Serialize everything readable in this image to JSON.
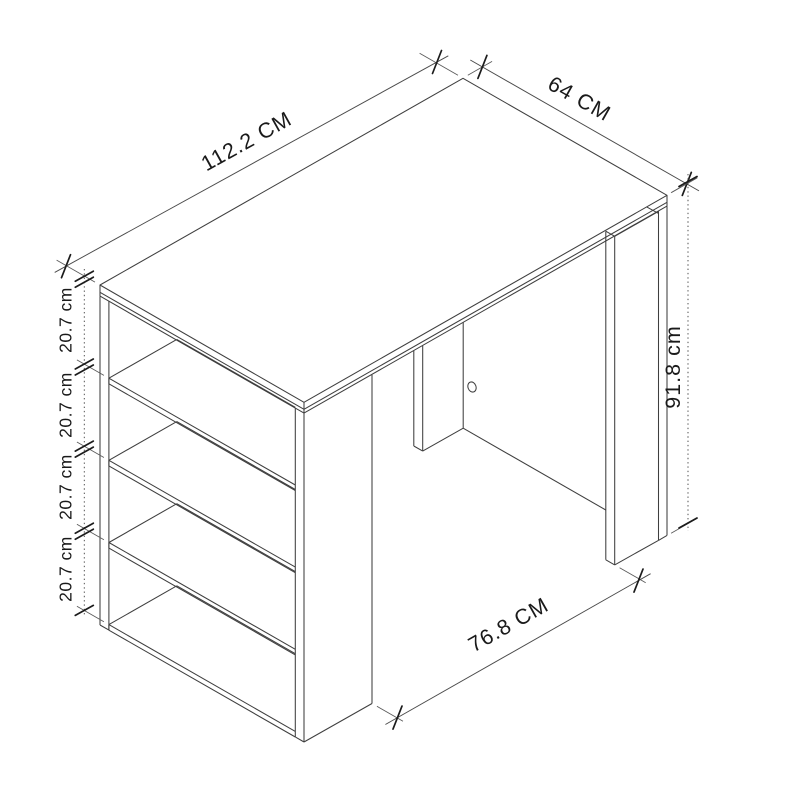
{
  "page": {
    "background": "#ffffff"
  },
  "drawing": {
    "kind": "isometric dimensioned line drawing",
    "subject": "bar table with four-shelf side rack",
    "line_color": "#3f3f3f",
    "text_color": "#1a1a1a",
    "dimensions": {
      "top_length": {
        "label": "112.2 CM"
      },
      "top_depth": {
        "label": "64 CM"
      },
      "height": {
        "label": "91.8 cm"
      },
      "bottom_span": {
        "label": "76.8 CM"
      },
      "shelf_gaps": [
        {
          "label": "20.7 cm"
        },
        {
          "label": "20.7 cm"
        },
        {
          "label": "20.7 cm"
        },
        {
          "label": "20.7 cm"
        }
      ]
    }
  }
}
